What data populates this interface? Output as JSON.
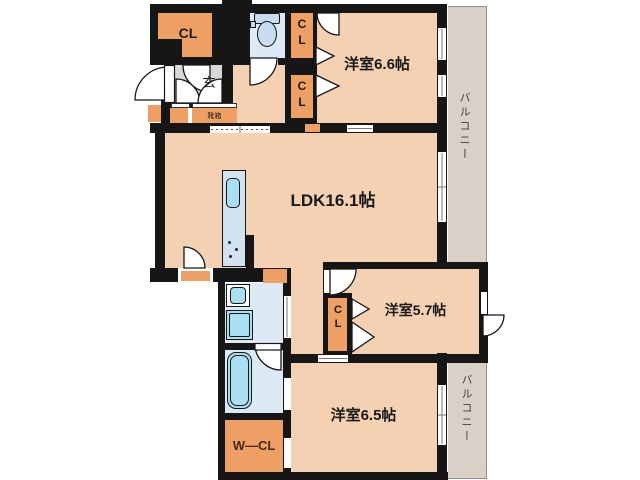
{
  "plan": {
    "rooms": [
      {
        "id": "room-66",
        "label": "洋室6.6帖"
      },
      {
        "id": "ldk",
        "label": "LDK16.1帖"
      },
      {
        "id": "room-57",
        "label": "洋室5.7帖"
      },
      {
        "id": "room-65",
        "label": "洋室6.5帖"
      }
    ],
    "closets": {
      "top_left": "CL",
      "upper_column": "CL",
      "middle_column": "CL",
      "room57": "CL",
      "walk_in": "W—CL"
    },
    "entrance": {
      "label": "玄",
      "shoe_box": "靴箱"
    },
    "balconies": {
      "top": "バルコニー",
      "bottom": "バルコニー"
    },
    "fixtures": [
      "toilet-icon",
      "kitchen-sink-icon",
      "stove-burners-icon",
      "washbasin-icon",
      "washing-machine-icon",
      "bathtub-icon"
    ],
    "colors": {
      "wall": "#161616",
      "room": "#f4d1b2",
      "closet": "#ee9f63",
      "wet": "#dde9f4",
      "entrance": "#d8d8d8",
      "balcony": "#d9d0c8",
      "cyan": "#a9dff0",
      "counter": "#d2e2ee",
      "toiletFixture": "#c9dbee",
      "text": "#1a1a1a",
      "wclText": "#4a2818",
      "balconyText": "#3c3c3c",
      "outline": "#8f8f8f"
    }
  }
}
